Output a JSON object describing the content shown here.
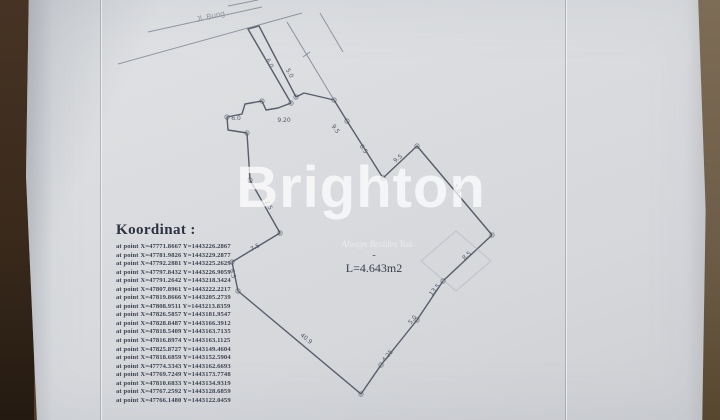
{
  "photo": {
    "surface_color": "#5b4530",
    "paper_color": "#d8dadd",
    "ink_color": "#49505e",
    "road_color": "#7d8390",
    "faint_color": "#a9aeb8"
  },
  "street_label": {
    "text": "Jl. Bung"
  },
  "watermark": {
    "brand": "Brighton",
    "tagline": "Always Besides You",
    "color": "#ffffff"
  },
  "area_label": {
    "text": "L=4.643m2",
    "dash": "-"
  },
  "koordinat": {
    "heading": "Koordinat :",
    "points": [
      "at point X=47771.8667 Y=1443226.2867",
      "at point X=47781.9826 Y=1443229.2877",
      "at point X=47792.2881 Y=1443225.2629",
      "at point X=47797.8432 Y=1443226.9059",
      "at point X=47791.2642 Y=1443218.3424",
      "at point X=47807.8961 Y=1443222.2217",
      "at point X=47819.8666 Y=1443205.2739",
      "at point X=47808.9511 Y=1443213.8359",
      "at point X=47826.5857 Y=1443181.9547",
      "at point X=47828.8487 Y=1443166.3912",
      "at point X=47818.5409 Y=1443163.7135",
      "at point X=47816.8974 Y=1443163.1125",
      "at point X=47825.8727 Y=1443149.4604",
      "at point X=47818.6859 Y=1443152.5904",
      "at point X=47774.3343 Y=1443162.6693",
      "at point X=47769.7249 Y=1443173.7748",
      "at point X=47810.6833 Y=1443134.9319",
      "at point X=47767.2592 Y=1443128.6859",
      "at point X=47766.1480 Y=1443122.0459"
    ]
  },
  "plan": {
    "polygon": [
      [
        248,
        29
      ],
      [
        259,
        26
      ],
      [
        296,
        97
      ],
      [
        304,
        93
      ],
      [
        334,
        100
      ],
      [
        347,
        121
      ],
      [
        383,
        178
      ],
      [
        417,
        146
      ],
      [
        492,
        235
      ],
      [
        443,
        281
      ],
      [
        417,
        320
      ],
      [
        381,
        365
      ],
      [
        361,
        394
      ],
      [
        238,
        291
      ],
      [
        232,
        262
      ],
      [
        280,
        233
      ],
      [
        250,
        180
      ],
      [
        247,
        133
      ],
      [
        228,
        130
      ],
      [
        227,
        117
      ],
      [
        242,
        114
      ],
      [
        245,
        104
      ],
      [
        262,
        101
      ],
      [
        266,
        110
      ],
      [
        278,
        108
      ],
      [
        291,
        103
      ]
    ],
    "road_lines": [
      {
        "x1": 118,
        "y1": 64,
        "x2": 302,
        "y2": 13
      },
      {
        "x1": 148,
        "y1": 32,
        "x2": 262,
        "y2": 7
      },
      {
        "x1": 228,
        "y1": 6,
        "x2": 258,
        "y2": 0
      },
      {
        "x1": 320,
        "y1": 13,
        "x2": 343,
        "y2": 52
      }
    ],
    "extra_lines": [
      {
        "x1": 287,
        "y1": 22,
        "x2": 334,
        "y2": 100
      },
      {
        "x1": 303,
        "y1": 57,
        "x2": 310,
        "y2": 52
      }
    ],
    "building_outline": [
      [
        421,
        261
      ],
      [
        456,
        231
      ],
      [
        491,
        261
      ],
      [
        456,
        291
      ]
    ],
    "vertices": [
      [
        296,
        97
      ],
      [
        334,
        100
      ],
      [
        347,
        121
      ],
      [
        383,
        178
      ],
      [
        417,
        146
      ],
      [
        492,
        235
      ],
      [
        443,
        281
      ],
      [
        417,
        320
      ],
      [
        381,
        365
      ],
      [
        361,
        394
      ],
      [
        238,
        291
      ],
      [
        232,
        262
      ],
      [
        280,
        233
      ],
      [
        250,
        180
      ],
      [
        247,
        133
      ],
      [
        227,
        117
      ],
      [
        262,
        101
      ],
      [
        291,
        103
      ]
    ],
    "edge_labels": [
      {
        "t": "6.0",
        "x": 268,
        "y": 64,
        "r": 62
      },
      {
        "t": "5.0",
        "x": 288,
        "y": 74,
        "r": 62
      },
      {
        "t": "6.0",
        "x": 236,
        "y": 120,
        "r": 0
      },
      {
        "t": "9.20",
        "x": 284,
        "y": 122,
        "r": 0
      },
      {
        "t": "9.5",
        "x": 334,
        "y": 130,
        "r": 55
      },
      {
        "t": "6.5",
        "x": 362,
        "y": 150,
        "r": 57
      },
      {
        "t": "9.5",
        "x": 399,
        "y": 160,
        "r": -38
      },
      {
        "t": "7.0",
        "x": 456,
        "y": 190,
        "r": 47
      },
      {
        "t": "8.5",
        "x": 468,
        "y": 257,
        "r": -42
      },
      {
        "t": "13.5",
        "x": 436,
        "y": 291,
        "r": -50
      },
      {
        "t": "5.0",
        "x": 414,
        "y": 321,
        "r": -50
      },
      {
        "t": "4.25",
        "x": 389,
        "y": 357,
        "r": -50
      },
      {
        "t": "40.9",
        "x": 305,
        "y": 340,
        "r": 40
      },
      {
        "t": "7.5",
        "x": 256,
        "y": 249,
        "r": -30
      },
      {
        "t": "6.5",
        "x": 231,
        "y": 274,
        "r": 78
      },
      {
        "t": "2.5",
        "x": 267,
        "y": 206,
        "r": 62
      }
    ]
  }
}
